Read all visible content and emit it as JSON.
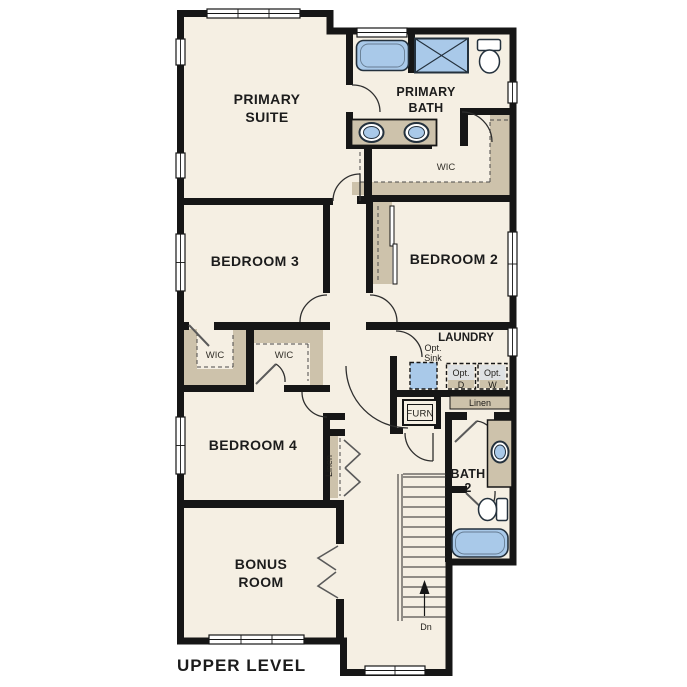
{
  "title": {
    "label": "UPPER LEVEL"
  },
  "colors": {
    "floor": "#f5efe3",
    "wall": "#161616",
    "fixture_blue": "#a9c9e9",
    "shelf_tan": "#cdc2ab",
    "appliance_gray": "#dfe2e4",
    "text": "#1c1c1c"
  },
  "rooms": {
    "primary_suite": {
      "line1": "PRIMARY",
      "line2": "SUITE"
    },
    "primary_bath": {
      "line1": "PRIMARY",
      "line2": "BATH"
    },
    "primary_wic": {
      "label": "WIC"
    },
    "bedroom3": {
      "label": "BEDROOM 3"
    },
    "bedroom2": {
      "label": "BEDROOM 2"
    },
    "wic_bedroom3": {
      "label": "WIC"
    },
    "wic_bedroom4": {
      "label": "WIC"
    },
    "bedroom4": {
      "label": "BEDROOM 4"
    },
    "bonus_room": {
      "line1": "BONUS",
      "line2": "ROOM"
    },
    "laundry": {
      "label": "LAUNDRY"
    },
    "bath2": {
      "line1": "BATH",
      "line2": "2"
    }
  },
  "annotations": {
    "opt_sink": {
      "line1": "Opt.",
      "line2": "Sink"
    },
    "opt_dryer": {
      "top": "Opt.",
      "letter": "D"
    },
    "opt_washer": {
      "top": "Opt.",
      "letter": "W"
    },
    "linen_laundry": "Linen",
    "linen_hall": "Linen",
    "furnace": "FURN",
    "stairs_direction": "Dn"
  }
}
